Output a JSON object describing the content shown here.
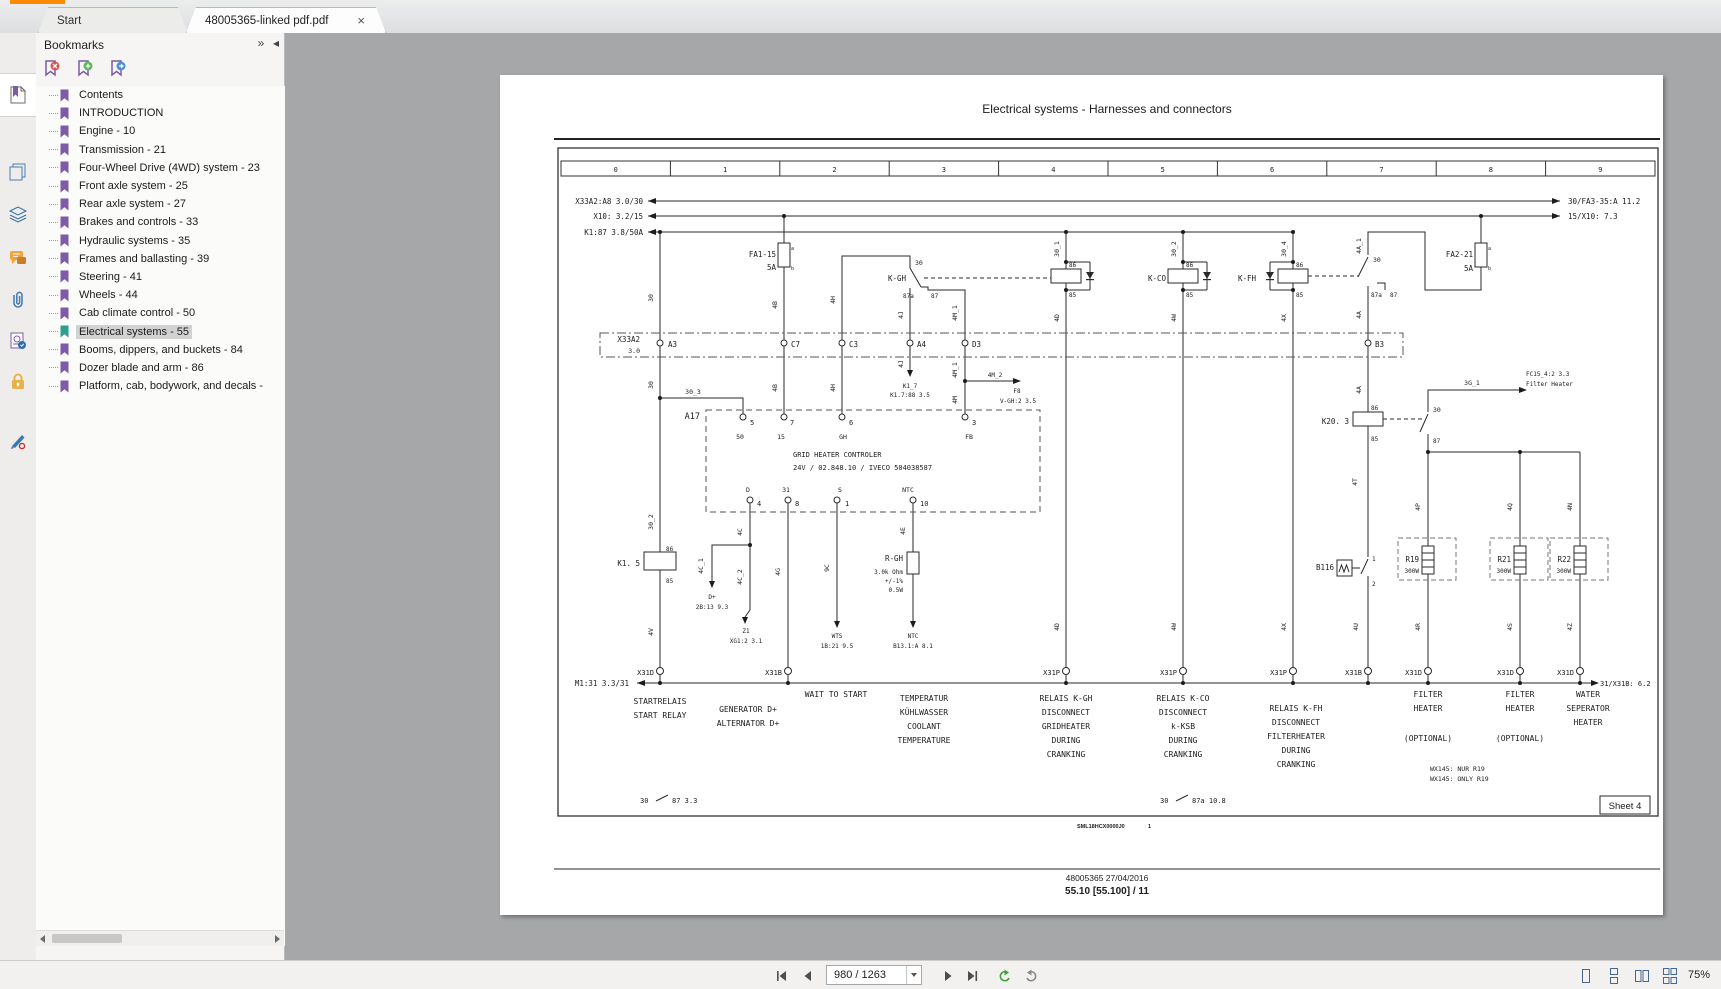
{
  "window": {
    "accent_color": "#ff8a00",
    "canvas_color": "#a6a7a9"
  },
  "tabs": {
    "start_label": "Start",
    "doc_label": "48005365-linked pdf.pdf",
    "close_glyph": "×"
  },
  "panel": {
    "title": "Bookmarks",
    "collapse_glyph": "»",
    "pin_glyph": "◂",
    "items": [
      {
        "label": "Contents",
        "selected": false
      },
      {
        "label": "INTRODUCTION",
        "selected": false
      },
      {
        "label": "Engine - 10",
        "selected": false
      },
      {
        "label": "Transmission - 21",
        "selected": false
      },
      {
        "label": "Four-Wheel Drive (4WD) system - 23",
        "selected": false
      },
      {
        "label": "Front axle system - 25",
        "selected": false
      },
      {
        "label": "Rear axle system - 27",
        "selected": false
      },
      {
        "label": "Brakes and controls - 33",
        "selected": false
      },
      {
        "label": "Hydraulic systems - 35",
        "selected": false
      },
      {
        "label": "Frames and ballasting - 39",
        "selected": false
      },
      {
        "label": "Steering - 41",
        "selected": false
      },
      {
        "label": "Wheels - 44",
        "selected": false
      },
      {
        "label": "Cab climate control - 50",
        "selected": false
      },
      {
        "label": "Electrical systems - 55",
        "selected": true
      },
      {
        "label": "Booms, dippers, and buckets - 84",
        "selected": false
      },
      {
        "label": "Dozer blade and arm - 86",
        "selected": false
      },
      {
        "label": "Platform, cab, bodywork, and decals -",
        "selected": false
      }
    ]
  },
  "statusbar": {
    "page_field": "980 / 1263",
    "zoom_level": "75%"
  },
  "document": {
    "title": "Electrical systems - Harnesses and connectors",
    "ruler": [
      "0",
      "1",
      "2",
      "3",
      "4",
      "5",
      "6",
      "7",
      "8",
      "9"
    ],
    "sheet_label": "Sheet 4",
    "code": "SML18HCX0000J0",
    "code_page": "1",
    "footer_line1": "48005365 27/04/2016",
    "footer_line2": "55.10 [55.100] / 11"
  },
  "diagram": {
    "labels": [
      [
        643,
        204,
        "X33A2:A8 3.0/30",
        "e",
        0
      ],
      [
        643,
        219,
        "X10: 3.2/15",
        "e",
        0
      ],
      [
        643,
        235,
        "K1:87 3.8/50A",
        "e",
        0
      ],
      [
        1568,
        204,
        "30/FA3-35:A 11.2",
        "s",
        0
      ],
      [
        1568,
        219,
        "15/X10: 7.3",
        "s",
        0
      ],
      [
        776,
        257,
        "FA1-15",
        "e",
        0
      ],
      [
        776,
        270,
        "5A",
        "e",
        0
      ],
      [
        791,
        250,
        "a",
        "s",
        0,
        5
      ],
      [
        791,
        270,
        "b",
        "s",
        0,
        5
      ],
      [
        1473,
        257,
        "FA2-21",
        "e",
        0
      ],
      [
        1473,
        271,
        "5A",
        "e",
        0
      ],
      [
        1488,
        250,
        "a",
        "s",
        0,
        5
      ],
      [
        1488,
        270,
        "b",
        "s",
        0,
        5
      ],
      [
        906,
        281,
        "K-GH",
        "e",
        0
      ],
      [
        915,
        265,
        "30",
        "s",
        0,
        6.5
      ],
      [
        903,
        298,
        "87a",
        "s",
        0,
        6
      ],
      [
        931,
        298,
        "87",
        "s",
        0,
        6
      ],
      [
        1166,
        281,
        "K-CO",
        "e",
        0
      ],
      [
        1256,
        281,
        "K-FH",
        "e",
        0
      ],
      [
        1069,
        267,
        "86",
        "s",
        0,
        6
      ],
      [
        1069,
        297,
        "85",
        "s",
        0,
        6
      ],
      [
        1186,
        267,
        "86",
        "s",
        0,
        6
      ],
      [
        1186,
        297,
        "85",
        "s",
        0,
        6
      ],
      [
        1296,
        267,
        "86",
        "s",
        0,
        6
      ],
      [
        1296,
        297,
        "85",
        "s",
        0,
        6
      ],
      [
        1059,
        249,
        "30_1",
        "m",
        1,
        6.5
      ],
      [
        1176,
        249,
        "30_2",
        "m",
        1,
        6.5
      ],
      [
        1286,
        249,
        "30_4",
        "m",
        1,
        6.5
      ],
      [
        1361,
        246,
        "4A_1",
        "m",
        1,
        6.5
      ],
      [
        1373,
        262,
        "30",
        "s",
        0,
        6.5
      ],
      [
        1371,
        297,
        "87a",
        "s",
        0,
        6
      ],
      [
        1390,
        297,
        "87",
        "s",
        0,
        6
      ],
      [
        640,
        342,
        "X33A2",
        "e",
        0
      ],
      [
        640,
        353,
        "3.0",
        "e",
        0,
        6.5
      ],
      [
        668,
        347,
        "A3",
        "s",
        0
      ],
      [
        791,
        347,
        "C7",
        "s",
        0
      ],
      [
        849,
        347,
        "C3",
        "s",
        0
      ],
      [
        917,
        347,
        "A4",
        "s",
        0
      ],
      [
        972,
        347,
        "D3",
        "s",
        0
      ],
      [
        1375,
        347,
        "B3",
        "s",
        0
      ],
      [
        653,
        298,
        "30",
        "m",
        1,
        6.5
      ],
      [
        777,
        305,
        "4B",
        "m",
        1,
        6.5
      ],
      [
        835,
        300,
        "4H",
        "m",
        1,
        6.5
      ],
      [
        903,
        315,
        "4J",
        "m",
        1,
        6.5
      ],
      [
        957,
        313,
        "4M_1",
        "m",
        1,
        6.5
      ],
      [
        1361,
        315,
        "4A",
        "m",
        1,
        6.5
      ],
      [
        1059,
        318,
        "4D",
        "m",
        1,
        6.5
      ],
      [
        1176,
        318,
        "4W",
        "m",
        1,
        6.5
      ],
      [
        1286,
        318,
        "4X",
        "m",
        1,
        6.5
      ],
      [
        653,
        385,
        "30",
        "m",
        1,
        6.5
      ],
      [
        777,
        388,
        "4B",
        "m",
        1,
        6.5
      ],
      [
        835,
        388,
        "4H",
        "m",
        1,
        6.5
      ],
      [
        903,
        364,
        "4J",
        "m",
        1,
        6.5
      ],
      [
        957,
        370,
        "4M_1",
        "m",
        1,
        6.5
      ],
      [
        1361,
        390,
        "4A",
        "m",
        1,
        6.5
      ],
      [
        693,
        394,
        "30_3",
        "m",
        0,
        6.5
      ],
      [
        910,
        388,
        "K1_7",
        "m",
        0,
        6
      ],
      [
        910,
        397,
        "K1.7:88 3.5",
        "m",
        0,
        6
      ],
      [
        995,
        377,
        "4M_2",
        "m",
        0,
        6
      ],
      [
        1017,
        393,
        "F8",
        "m",
        0,
        6
      ],
      [
        1018,
        403,
        "V-GH:2 3.5",
        "m",
        0,
        6
      ],
      [
        957,
        400,
        "4M",
        "m",
        1,
        6.5
      ],
      [
        700,
        419,
        "A17",
        "e",
        0,
        8.5
      ],
      [
        750,
        425,
        "5",
        "s",
        0,
        7
      ],
      [
        790,
        425,
        "7",
        "s",
        0,
        7
      ],
      [
        849,
        425,
        "6",
        "s",
        0,
        7
      ],
      [
        972,
        425,
        "3",
        "s",
        0,
        7
      ],
      [
        740,
        439,
        "50",
        "m",
        0,
        6.5
      ],
      [
        781,
        439,
        "15",
        "m",
        0,
        6.5
      ],
      [
        843,
        439,
        "GH",
        "m",
        0,
        6.5
      ],
      [
        969,
        439,
        "FB",
        "m",
        0,
        6.5
      ],
      [
        793,
        457,
        "GRID HEATER CONTROLER",
        "s",
        0,
        7
      ],
      [
        793,
        470,
        "24V / 02.848.10 / IVECO 504038587",
        "s",
        0,
        7
      ],
      [
        748,
        492,
        "D",
        "m",
        0,
        6.5
      ],
      [
        786,
        492,
        "31",
        "m",
        0,
        6.5
      ],
      [
        840,
        492,
        "S",
        "m",
        0,
        6.5
      ],
      [
        908,
        492,
        "NTC",
        "m",
        0,
        6.5
      ],
      [
        757,
        506,
        "4",
        "s",
        0,
        7
      ],
      [
        795,
        506,
        "8",
        "s",
        0,
        7
      ],
      [
        845,
        506,
        "1",
        "s",
        0,
        7
      ],
      [
        920,
        506,
        "10",
        "s",
        0,
        7
      ],
      [
        640,
        566,
        "K1. 5",
        "e",
        0
      ],
      [
        666,
        551,
        "86",
        "s",
        0,
        6
      ],
      [
        666,
        583,
        "85",
        "s",
        0,
        6
      ],
      [
        653,
        522,
        "30_2",
        "m",
        1,
        6.5
      ],
      [
        653,
        632,
        "4V",
        "m",
        1,
        6.5
      ],
      [
        742,
        532,
        "4C",
        "m",
        1,
        6.5
      ],
      [
        703,
        566,
        "4C_1",
        "m",
        1,
        6.5
      ],
      [
        742,
        577,
        "4C_2",
        "m",
        1,
        6.5
      ],
      [
        712,
        599,
        "D+",
        "m",
        0,
        6
      ],
      [
        712,
        609,
        "2B:13 9.3",
        "m",
        0,
        6
      ],
      [
        746,
        633,
        "Z1",
        "m",
        0,
        6
      ],
      [
        746,
        643,
        "XG1:2 3.1",
        "m",
        0,
        6
      ],
      [
        780,
        572,
        "4G",
        "m",
        1,
        6.5
      ],
      [
        829,
        568,
        "9C",
        "m",
        1,
        6.5
      ],
      [
        837,
        638,
        "WTS",
        "m",
        0,
        6
      ],
      [
        837,
        648,
        "1B:21 9.5",
        "m",
        0,
        6
      ],
      [
        905,
        531,
        "4E",
        "m",
        1,
        6.5
      ],
      [
        903,
        561,
        "R-GH",
        "e",
        0
      ],
      [
        903,
        574,
        "3.0k Ohm",
        "e",
        0,
        6
      ],
      [
        903,
        583,
        "+/-1%",
        "e",
        0,
        6
      ],
      [
        903,
        592,
        "0.5W",
        "e",
        0,
        6
      ],
      [
        913,
        638,
        "NTC",
        "m",
        0,
        6
      ],
      [
        913,
        648,
        "B13.1:A 8.1",
        "m",
        0,
        6
      ],
      [
        1059,
        627,
        "4D",
        "m",
        1,
        6.5
      ],
      [
        1176,
        627,
        "4W",
        "m",
        1,
        6.5
      ],
      [
        1286,
        627,
        "4X",
        "m",
        1,
        6.5
      ],
      [
        1349,
        424,
        "K20. 3",
        "e",
        0
      ],
      [
        1371,
        410,
        "86",
        "s",
        0,
        6
      ],
      [
        1371,
        441,
        "85",
        "s",
        0,
        6
      ],
      [
        1472,
        385,
        "3G_1",
        "m",
        0,
        6.5
      ],
      [
        1433,
        412,
        "30",
        "s",
        0,
        6.5
      ],
      [
        1433,
        443,
        "87",
        "s",
        0,
        6
      ],
      [
        1526,
        376,
        "FC15_4:2 3.3",
        "s",
        0,
        6
      ],
      [
        1526,
        386,
        "Filter Heater",
        "s",
        0,
        6
      ],
      [
        1357,
        482,
        "4T",
        "m",
        1,
        6.5
      ],
      [
        1334,
        570,
        "B116",
        "e",
        0
      ],
      [
        1372,
        561,
        "1",
        "s",
        0,
        6
      ],
      [
        1372,
        586,
        "2",
        "s",
        0,
        6
      ],
      [
        1358,
        627,
        "4U",
        "m",
        1,
        6.5
      ],
      [
        1420,
        507,
        "4P",
        "m",
        1,
        6.5
      ],
      [
        1512,
        507,
        "4Q",
        "m",
        1,
        6.5
      ],
      [
        1572,
        507,
        "4N",
        "m",
        1,
        6.5
      ],
      [
        1419,
        562,
        "R19",
        "e",
        0
      ],
      [
        1419,
        573,
        "300W",
        "e",
        0,
        6
      ],
      [
        1511,
        562,
        "R21",
        "e",
        0
      ],
      [
        1511,
        573,
        "300W",
        "e",
        0,
        6
      ],
      [
        1571,
        562,
        "R22",
        "e",
        0
      ],
      [
        1571,
        573,
        "300W",
        "e",
        0,
        6
      ],
      [
        1420,
        627,
        "4R",
        "m",
        1,
        6.5
      ],
      [
        1512,
        627,
        "4S",
        "m",
        1,
        6.5
      ],
      [
        1572,
        627,
        "4Z",
        "m",
        1,
        6.5
      ],
      [
        629,
        686,
        "M1:31 3.3/31",
        "e",
        0
      ],
      [
        1600,
        686,
        "31/X31B: 6.2",
        "s",
        0,
        7
      ],
      [
        654,
        675,
        "X31D",
        "e",
        0,
        7
      ],
      [
        782,
        675,
        "X31B",
        "e",
        0,
        7
      ],
      [
        1060,
        675,
        "X31P",
        "e",
        0,
        7
      ],
      [
        1177,
        675,
        "X31P",
        "e",
        0,
        7
      ],
      [
        1287,
        675,
        "X31P",
        "e",
        0,
        7
      ],
      [
        1362,
        675,
        "X31B",
        "e",
        0,
        7
      ],
      [
        1422,
        675,
        "X31D",
        "e",
        0,
        7
      ],
      [
        1514,
        675,
        "X31D",
        "e",
        0,
        7
      ],
      [
        1574,
        675,
        "X31D",
        "e",
        0,
        7
      ],
      [
        660,
        704,
        "STARTRELAIS",
        "m",
        0,
        8
      ],
      [
        660,
        718,
        "START RELAY",
        "m",
        0,
        8
      ],
      [
        748,
        712,
        "GENERATOR D+",
        "m",
        0,
        8
      ],
      [
        748,
        726,
        "ALTERNATOR D+",
        "m",
        0,
        8
      ],
      [
        836,
        697,
        "WAIT TO START",
        "m",
        0,
        8
      ],
      [
        924,
        701,
        "TEMPERATUR",
        "m",
        0,
        8
      ],
      [
        924,
        715,
        "KÜHLWASSER",
        "m",
        0,
        8
      ],
      [
        924,
        729,
        "COOLANT",
        "m",
        0,
        8
      ],
      [
        924,
        743,
        "TEMPERATURE",
        "m",
        0,
        8
      ],
      [
        1066,
        701,
        "RELAIS K-GH",
        "m",
        0,
        8
      ],
      [
        1066,
        715,
        "DISCONNECT",
        "m",
        0,
        8
      ],
      [
        1066,
        729,
        "GRIDHEATER",
        "m",
        0,
        8
      ],
      [
        1066,
        743,
        "DURING",
        "m",
        0,
        8
      ],
      [
        1066,
        757,
        "CRANKING",
        "m",
        0,
        8
      ],
      [
        1183,
        701,
        "RELAIS K-CO",
        "m",
        0,
        8
      ],
      [
        1183,
        715,
        "DISCONNECT",
        "m",
        0,
        8
      ],
      [
        1183,
        729,
        "k-KSB",
        "m",
        0,
        8
      ],
      [
        1183,
        743,
        "DURING",
        "m",
        0,
        8
      ],
      [
        1183,
        757,
        "CRANKING",
        "m",
        0,
        8
      ],
      [
        1296,
        711,
        "RELAIS K-FH",
        "m",
        0,
        8
      ],
      [
        1296,
        725,
        "DISCONNECT",
        "m",
        0,
        8
      ],
      [
        1296,
        739,
        "FILTERHEATER",
        "m",
        0,
        8
      ],
      [
        1296,
        753,
        "DURING",
        "m",
        0,
        8
      ],
      [
        1296,
        767,
        "CRANKING",
        "m",
        0,
        8
      ],
      [
        1428,
        697,
        "FILTER",
        "m",
        0,
        8
      ],
      [
        1428,
        711,
        "HEATER",
        "m",
        0,
        8
      ],
      [
        1428,
        741,
        "(OPTIONAL)",
        "m",
        0,
        8
      ],
      [
        1520,
        697,
        "FILTER",
        "m",
        0,
        8
      ],
      [
        1520,
        711,
        "HEATER",
        "m",
        0,
        8
      ],
      [
        1520,
        741,
        "(OPTIONAL)",
        "m",
        0,
        8
      ],
      [
        1588,
        697,
        "WATER",
        "m",
        0,
        8
      ],
      [
        1588,
        711,
        "SEPERATOR",
        "m",
        0,
        8
      ],
      [
        1588,
        725,
        "HEATER",
        "m",
        0,
        8
      ],
      [
        1430,
        771,
        "WX145: NUR R19",
        "s",
        0,
        6.5
      ],
      [
        1430,
        781,
        "WX145: ONLY R19",
        "s",
        0,
        6.5
      ],
      [
        640,
        803,
        "30",
        "s",
        0,
        7
      ],
      [
        672,
        803,
        "87  3.3",
        "s",
        0,
        7
      ],
      [
        1160,
        803,
        "30",
        "s",
        0,
        7
      ],
      [
        1192,
        803,
        "87a  10.8",
        "s",
        0,
        7
      ]
    ]
  }
}
